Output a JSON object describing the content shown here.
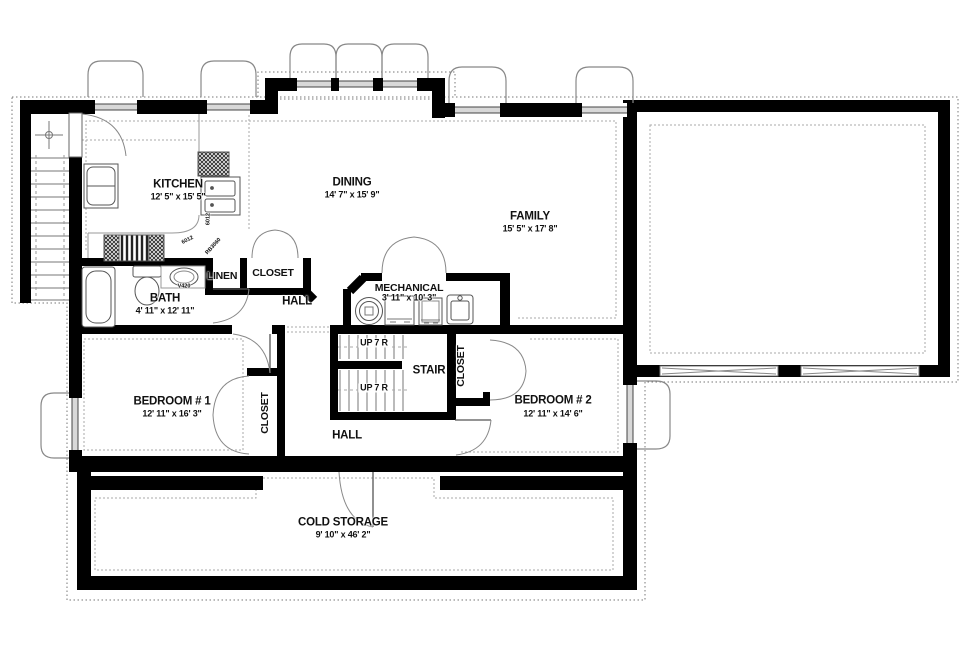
{
  "rooms": {
    "kitchen": {
      "name": "KITCHEN",
      "dims": "12' 5\" x 15' 5\""
    },
    "dining": {
      "name": "DINING",
      "dims": "14' 7\" x 15' 9\""
    },
    "family": {
      "name": "FAMILY",
      "dims": "15' 5\" x 17' 8\""
    },
    "bath": {
      "name": "BATH",
      "dims": "4' 11\" x 12' 11\""
    },
    "linen": {
      "name": "LINEN"
    },
    "hall_closet": {
      "name": "CLOSET"
    },
    "hall_upper": {
      "name": "HALL"
    },
    "mechanical": {
      "name": "MECHANICAL",
      "dims": "3' 11\" x 10' 3\""
    },
    "stair": {
      "name": "STAIR",
      "up1": "UP 7 R",
      "up2": "UP 7 R"
    },
    "bedroom1": {
      "name": "BEDROOM # 1",
      "dims": "12' 11\" x 16' 3\""
    },
    "bedroom1_closet": {
      "name": "CLOSET"
    },
    "bedroom2": {
      "name": "BEDROOM # 2",
      "dims": "12' 11\" x 14' 6\""
    },
    "bedroom2_closet": {
      "name": "CLOSET"
    },
    "hall_lower": {
      "name": "HALL"
    },
    "cold_storage": {
      "name": "COLD STORAGE",
      "dims": "9' 10\" x 46' 2\""
    }
  },
  "fixture_labels": {
    "counter_side": "6012",
    "counter_range": "6012",
    "corner_cabinet": "RB3060",
    "vanity_sink": "V420"
  },
  "colors": {
    "wall": "#000000",
    "thin_line": "#555555",
    "dotted": "#999999",
    "text": "#111111"
  }
}
